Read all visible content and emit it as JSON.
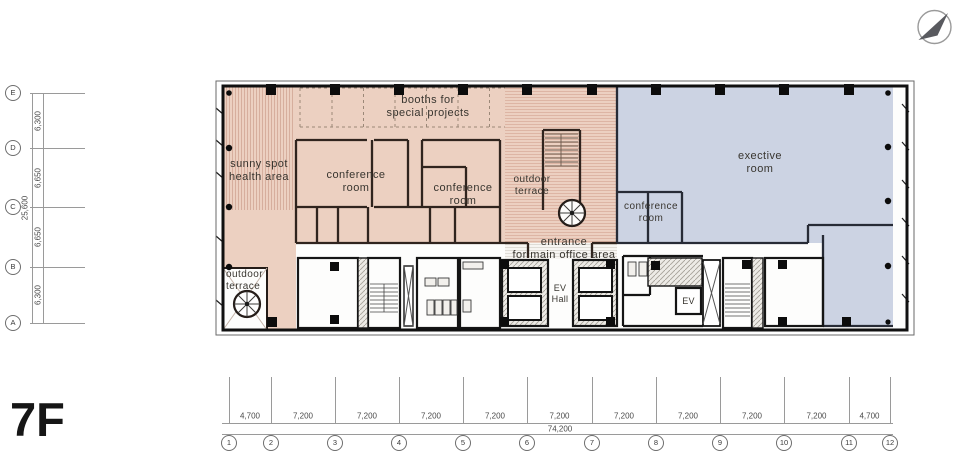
{
  "floor_label": "7F",
  "icons": {
    "compass": "north-arrow"
  },
  "rooms": {
    "booths": [
      "booths for",
      "special projects"
    ],
    "sunny": [
      "sunny spot",
      "health area"
    ],
    "conference1": [
      "conference",
      "room"
    ],
    "conference2": [
      "conference",
      "room"
    ],
    "terrace_top": [
      "outdoor",
      "terrace"
    ],
    "executive": [
      "exective",
      "room"
    ],
    "conference3": [
      "conference",
      "room"
    ],
    "entrance": [
      "entrance",
      "for main office area"
    ],
    "terrace_bottom": [
      "outdoor",
      "terrace"
    ],
    "ev_hall": [
      "EV",
      "Hall"
    ],
    "ev": "EV"
  },
  "grid": {
    "rows": [
      "E",
      "D",
      "C",
      "B",
      "A"
    ],
    "row_dims": [
      "6,300",
      "6,650",
      "6,650",
      "6,300"
    ],
    "row_total": "25,600",
    "cols": [
      "1",
      "2",
      "3",
      "4",
      "5",
      "6",
      "7",
      "8",
      "9",
      "10",
      "11",
      "12"
    ],
    "col_dims": [
      "4,700",
      "7,200",
      "7,200",
      "7,200",
      "7,200",
      "7,200",
      "7,200",
      "7,200",
      "7,200",
      "7,200",
      "4,700"
    ],
    "col_total": "74,200"
  },
  "colors": {
    "zone_pink": "#ecd0c1",
    "zone_blue": "#ccd3e3",
    "wall": "#181712"
  }
}
